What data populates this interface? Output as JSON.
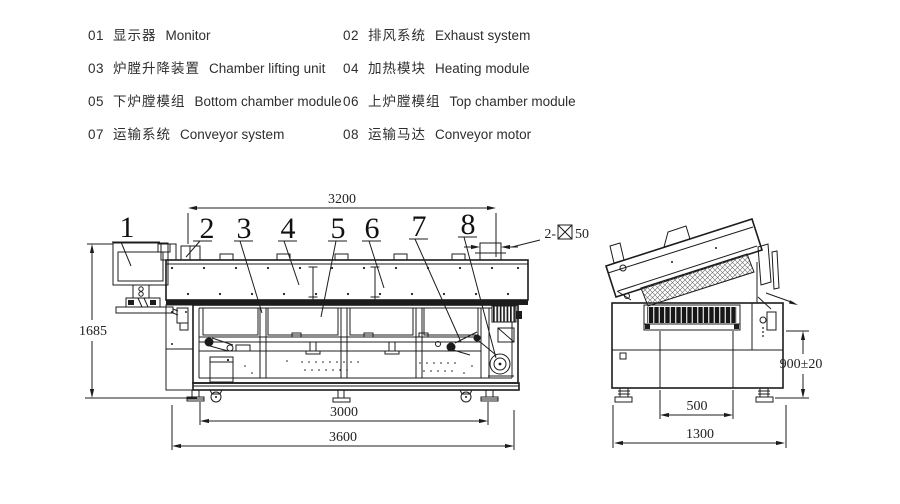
{
  "legend": {
    "items": [
      {
        "num": "01",
        "cn": "显示器",
        "en": "Monitor"
      },
      {
        "num": "02",
        "cn": "排风系统",
        "en": "Exhaust system"
      },
      {
        "num": "03",
        "cn": "炉膛升降装置",
        "en": "Chamber lifting unit"
      },
      {
        "num": "04",
        "cn": "加热模块",
        "en": "Heating module"
      },
      {
        "num": "05",
        "cn": "下炉膛模组",
        "en": "Bottom chamber module"
      },
      {
        "num": "06",
        "cn": "上炉膛模组",
        "en": "Top chamber module"
      },
      {
        "num": "07",
        "cn": "运输系统",
        "en": "Conveyor system"
      },
      {
        "num": "08",
        "cn": "运输马达",
        "en": "Conveyor motor"
      }
    ]
  },
  "front_view": {
    "part_labels": [
      "1",
      "2",
      "3",
      "4",
      "5",
      "6",
      "7",
      "8"
    ],
    "dims": {
      "top_width": "3200",
      "height": "1685",
      "feet_span": "3000",
      "overall_length": "3600",
      "exhaust_prefix": "2-",
      "exhaust_size": "50"
    }
  },
  "side_view": {
    "dims": {
      "conveyor_height": "900±20",
      "feet_span": "500",
      "overall_width": "1300"
    }
  },
  "colors": {
    "line": "#1c1c1c",
    "text": "#2e2e2e"
  }
}
